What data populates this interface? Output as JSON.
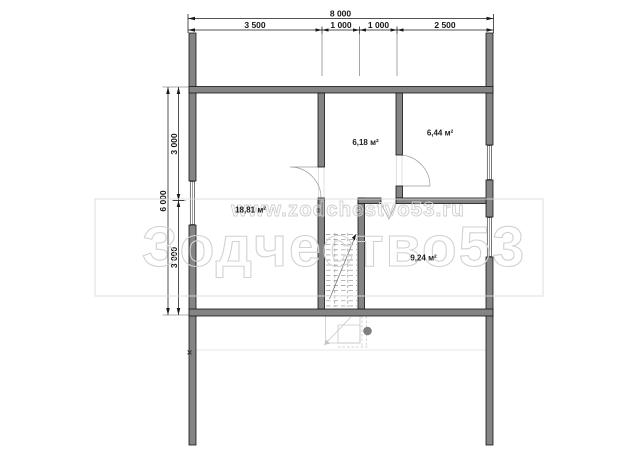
{
  "dimensions": {
    "top": {
      "total": "8 000",
      "segments": [
        "3 500",
        "1 000",
        "1 000",
        "2 500"
      ]
    },
    "left": {
      "total": "6 000",
      "segments": [
        "3 000",
        "3 000"
      ]
    }
  },
  "rooms": [
    {
      "area_label": "18,81 м²"
    },
    {
      "area_label": "6,18 м²"
    },
    {
      "area_label": "6,44 м²"
    },
    {
      "area_label": "9,24 м²"
    }
  ],
  "watermark": {
    "website": "www.zodchestvo53.ru",
    "brand": "Зодчество53"
  },
  "markers": {
    "wall_cross": "×"
  },
  "colors": {
    "wall_fill": "#848484",
    "line": "#1a1a1a",
    "watermark_line": "#d2d2d2"
  }
}
